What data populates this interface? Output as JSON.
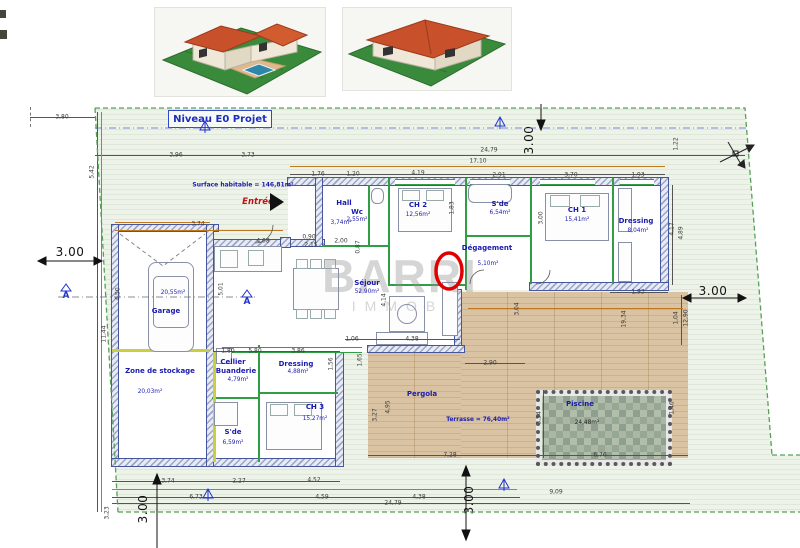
{
  "title": "Niveau E0  Projet",
  "watermark": {
    "line1": "BARRI",
    "line2": "IMMOB"
  },
  "notes": {
    "surface": "Surface habitable  = 146,81m²",
    "entrance": "Entrée",
    "section_marker": "A"
  },
  "rooms": [
    {
      "key": "garage",
      "name": "Garage",
      "area": "20,55m²",
      "nx": 166,
      "ny": 311,
      "ax": 173,
      "ay": 293
    },
    {
      "key": "zone-stockage",
      "name": "Zone de stockage",
      "area": "20,03m²",
      "nx": 160,
      "ny": 371,
      "ax": 150,
      "ay": 392
    },
    {
      "key": "cellier",
      "name": "Cellier",
      "n2": "Buanderie",
      "area": "4,79m²",
      "nx": 233,
      "ny": 362,
      "n2x": 236,
      "n2y": 371,
      "ax": 238,
      "ay": 380
    },
    {
      "key": "sde-bas",
      "name": "S'de",
      "area": "6,59m²",
      "nx": 233,
      "ny": 432,
      "ax": 233,
      "ay": 443
    },
    {
      "key": "dressing-bas",
      "name": "Dressing",
      "area": "4,88m²",
      "nx": 296,
      "ny": 364,
      "ax": 298,
      "ay": 372
    },
    {
      "key": "ch3",
      "name": "CH 3",
      "area": "15,27m²",
      "nx": 315,
      "ny": 407,
      "ax": 315,
      "ay": 419
    },
    {
      "key": "hall",
      "name": "Hall",
      "area": "3,74m²",
      "nx": 344,
      "ny": 203,
      "ax": 341,
      "ay": 223
    },
    {
      "key": "wc",
      "name": "Wc",
      "area": "2,55m²",
      "nx": 357,
      "ny": 212,
      "ax": 357,
      "ay": 220
    },
    {
      "key": "ch2",
      "name": "CH 2",
      "area": "12,56m²",
      "nx": 418,
      "ny": 205,
      "ax": 418,
      "ay": 215
    },
    {
      "key": "sde-haut",
      "name": "S'de",
      "area": "6,54m²",
      "nx": 500,
      "ny": 204,
      "ax": 500,
      "ay": 213
    },
    {
      "key": "ch1",
      "name": "CH 1",
      "area": "15,41m²",
      "nx": 577,
      "ny": 210,
      "ax": 577,
      "ay": 220
    },
    {
      "key": "dressing-haut",
      "name": "Dressing",
      "area": "8,04m²",
      "nx": 636,
      "ny": 221,
      "ax": 638,
      "ay": 231
    },
    {
      "key": "degagement",
      "name": "Dégagement",
      "area": "5,10m²",
      "nx": 487,
      "ny": 248,
      "ax": 488,
      "ay": 264
    },
    {
      "key": "sejour",
      "name": "Séjour",
      "area": "52,90m²",
      "nx": 367,
      "ny": 283,
      "ax": 367,
      "ay": 292
    },
    {
      "key": "pergola",
      "name": "Pergola",
      "area": "",
      "nx": 422,
      "ny": 394,
      "ax": 0,
      "ay": 0
    },
    {
      "key": "terrasse",
      "name": "Terrasse = 76,40m²",
      "area": "",
      "nx": 478,
      "ny": 420,
      "ax": 0,
      "ay": 0,
      "small": true
    },
    {
      "key": "piscine",
      "name": "Piscine",
      "area": "24,48m²",
      "nx": 580,
      "ny": 404,
      "ax": 587,
      "ay": 423,
      "dark": true
    }
  ],
  "dimensions": [
    {
      "t": "3,80",
      "x": 62,
      "y": 117
    },
    {
      "t": "3,96",
      "x": 176,
      "y": 155
    },
    {
      "t": "3,73",
      "x": 248,
      "y": 155
    },
    {
      "t": "24,79",
      "x": 489,
      "y": 150
    },
    {
      "t": "17,10",
      "x": 478,
      "y": 161
    },
    {
      "t": "5,42",
      "x": 92,
      "y": 172,
      "r": 1
    },
    {
      "t": "1,76",
      "x": 318,
      "y": 174
    },
    {
      "t": "1,20",
      "x": 353,
      "y": 174
    },
    {
      "t": "4,19",
      "x": 418,
      "y": 173
    },
    {
      "t": "2,91",
      "x": 499,
      "y": 175
    },
    {
      "t": "3,70",
      "x": 571,
      "y": 175
    },
    {
      "t": "1,93",
      "x": 638,
      "y": 175
    },
    {
      "t": "1,22",
      "x": 676,
      "y": 144,
      "r": 1
    },
    {
      "t": "3.00",
      "x": 529,
      "y": 140,
      "r": 1,
      "b": 1
    },
    {
      "t": "3,74",
      "x": 198,
      "y": 224
    },
    {
      "t": "1,83",
      "x": 452,
      "y": 208,
      "r": 1
    },
    {
      "t": "3,00",
      "x": 541,
      "y": 218,
      "r": 1
    },
    {
      "t": "4,08",
      "x": 263,
      "y": 241
    },
    {
      "t": "0,90",
      "x": 309,
      "y": 237
    },
    {
      "t": "2,15",
      "x": 311,
      "y": 245
    },
    {
      "t": "2,00",
      "x": 341,
      "y": 241
    },
    {
      "t": "0,87",
      "x": 358,
      "y": 247,
      "r": 1
    },
    {
      "t": "3.00",
      "x": 70,
      "y": 252,
      "b": 1
    },
    {
      "t": "3.00",
      "x": 713,
      "y": 291,
      "b": 1
    },
    {
      "t": "5,01",
      "x": 221,
      "y": 289,
      "r": 1
    },
    {
      "t": "4,14",
      "x": 384,
      "y": 300,
      "r": 1
    },
    {
      "t": "3,04",
      "x": 517,
      "y": 309,
      "r": 1
    },
    {
      "t": "4,50",
      "x": 118,
      "y": 294,
      "r": 1
    },
    {
      "t": "11,44",
      "x": 104,
      "y": 334,
      "r": 1
    },
    {
      "t": "19,34",
      "x": 624,
      "y": 319,
      "r": 1
    },
    {
      "t": "1,04",
      "x": 676,
      "y": 318,
      "r": 1
    },
    {
      "t": "12,90",
      "x": 686,
      "y": 318,
      "r": 1
    },
    {
      "t": "4,17",
      "x": 672,
      "y": 229,
      "r": 1
    },
    {
      "t": "4,89",
      "x": 681,
      "y": 233,
      "r": 1
    },
    {
      "t": "1,93",
      "x": 638,
      "y": 292
    },
    {
      "t": "1,80",
      "x": 228,
      "y": 351
    },
    {
      "t": "5,80",
      "x": 255,
      "y": 351
    },
    {
      "t": "3,86",
      "x": 298,
      "y": 351
    },
    {
      "t": "1,06",
      "x": 352,
      "y": 339
    },
    {
      "t": "4,38",
      "x": 412,
      "y": 339
    },
    {
      "t": "1,56",
      "x": 331,
      "y": 364,
      "r": 1
    },
    {
      "t": "1,65",
      "x": 360,
      "y": 360,
      "r": 1
    },
    {
      "t": "2,90",
      "x": 490,
      "y": 363
    },
    {
      "t": "3,27",
      "x": 375,
      "y": 415,
      "r": 1
    },
    {
      "t": "4,95",
      "x": 388,
      "y": 407,
      "r": 1
    },
    {
      "t": "3,54",
      "x": 539,
      "y": 418,
      "r": 1
    },
    {
      "t": "1,46",
      "x": 672,
      "y": 408,
      "r": 1
    },
    {
      "t": "7,28",
      "x": 450,
      "y": 455
    },
    {
      "t": "6,76",
      "x": 600,
      "y": 455
    },
    {
      "t": "3,74",
      "x": 168,
      "y": 481
    },
    {
      "t": "2,27",
      "x": 239,
      "y": 481
    },
    {
      "t": "4,52",
      "x": 314,
      "y": 480
    },
    {
      "t": "6,73",
      "x": 196,
      "y": 497
    },
    {
      "t": "4,59",
      "x": 322,
      "y": 497
    },
    {
      "t": "4,38",
      "x": 419,
      "y": 497
    },
    {
      "t": "24,79",
      "x": 393,
      "y": 503
    },
    {
      "t": "9,09",
      "x": 556,
      "y": 492
    },
    {
      "t": "3.00",
      "x": 143,
      "y": 509,
      "r": 1,
      "b": 1
    },
    {
      "t": "3.00",
      "x": 469,
      "y": 500,
      "r": 1,
      "b": 1
    },
    {
      "t": "3,23",
      "x": 107,
      "y": 513,
      "r": 1
    }
  ]
}
